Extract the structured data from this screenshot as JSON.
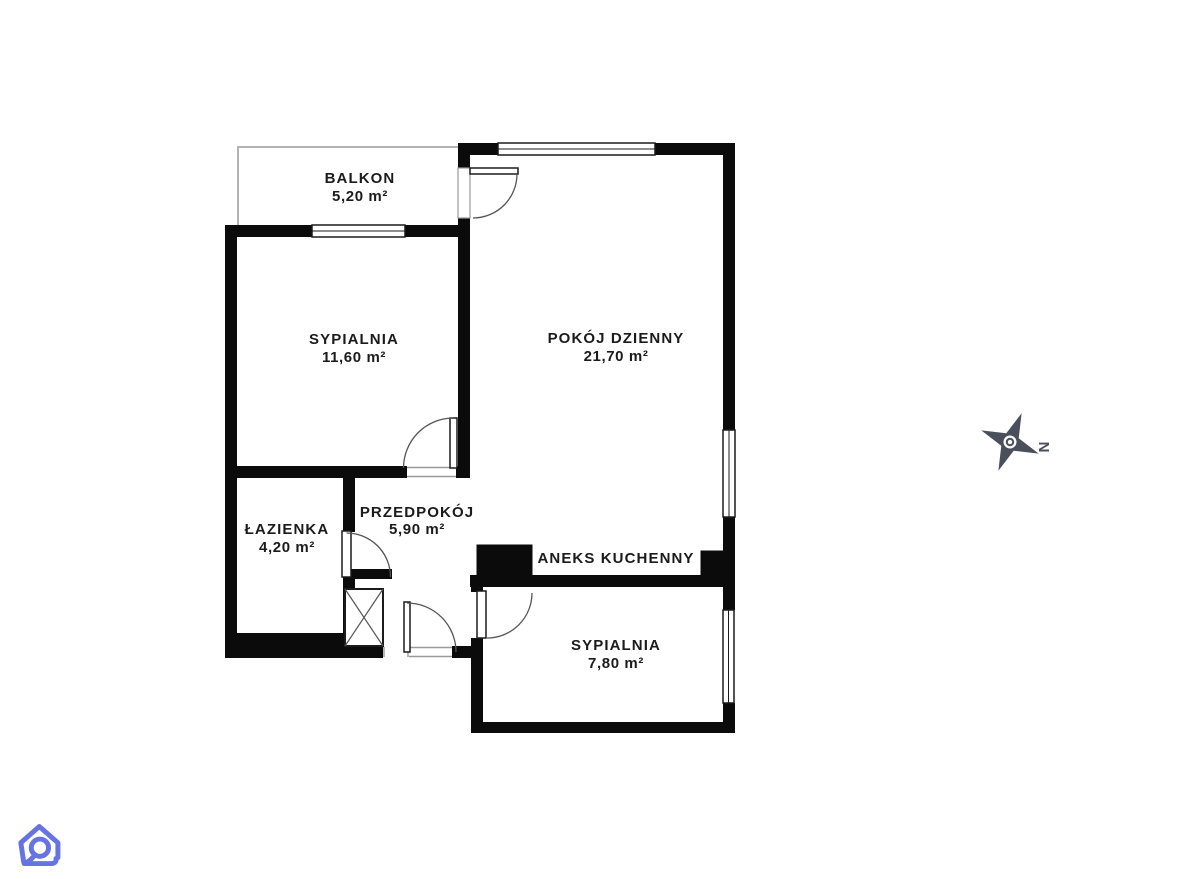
{
  "floorplan": {
    "title": "apartment-floor-plan",
    "rooms": [
      {
        "name": "BALKON",
        "area": "5,20 m²"
      },
      {
        "name": "SYPIALNIA",
        "area": "11,60 m²"
      },
      {
        "name": "POKÓJ DZIENNY",
        "area": "21,70 m²"
      },
      {
        "name": "PRZEDPOKÓJ",
        "area": "5,90 m²"
      },
      {
        "name": "ŁAZIENKA",
        "area": "4,20 m²"
      },
      {
        "name": "ANEKS KUCHENNY",
        "area": ""
      },
      {
        "name": "SYPIALNIA",
        "area": "7,80 m²"
      }
    ],
    "compass": {
      "north_label": "N"
    },
    "colors": {
      "wall": "#0b0b0b",
      "text": "#1b1b1b",
      "compass": "#4a4f5c",
      "logo": "#6673e3",
      "balcony_outline": "#b3b3b3",
      "background": "#ffffff"
    }
  }
}
